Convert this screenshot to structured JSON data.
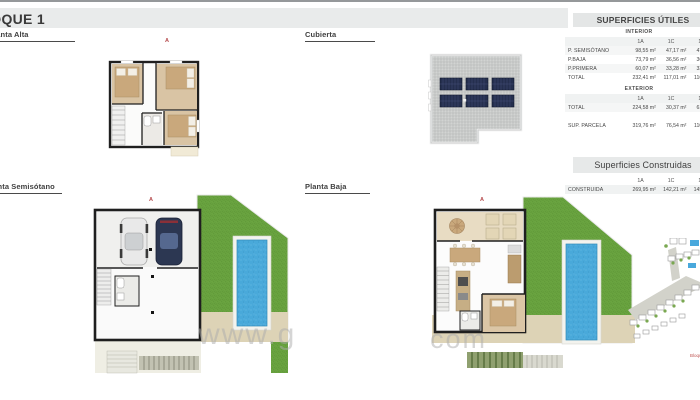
{
  "page": {
    "title": "BLOQUE 1"
  },
  "plans": {
    "planta_alta": {
      "label": "Planta Alta",
      "marker": "A"
    },
    "cubierta": {
      "label": "Cubierta"
    },
    "planta_semisotano": {
      "label": "Planta Semisótano",
      "marker": "A"
    },
    "planta_baja": {
      "label": "Planta Baja",
      "marker": "A"
    }
  },
  "tables": {
    "utiles": {
      "title": "SUPERFICIES ÚTILES",
      "interior": {
        "name": "INTERIOR",
        "columns": [
          "1A",
          "1C",
          "1D"
        ],
        "rows": [
          {
            "label": "P. SEMISÓTANO",
            "values": [
              "98,55 m²",
              "47,17 m²",
              "47,14 m²"
            ]
          },
          {
            "label": "P.BAJA",
            "values": [
              "73,79 m²",
              "36,56 m²",
              "36,46 m²"
            ]
          },
          {
            "label": "P.PRIMERA",
            "values": [
              "60,07 m²",
              "33,28 m²",
              "33,27 m²"
            ]
          },
          {
            "label": "TOTAL",
            "values": [
              "232,41 m²",
              "117,01 m²",
              "116,87 m²"
            ]
          }
        ]
      },
      "exterior": {
        "name": "EXTERIOR",
        "columns": [
          "1A",
          "1C",
          "1D"
        ],
        "rows": [
          {
            "label": "TOTAL",
            "values": [
              "224,58 m²",
              "30,37 m²",
              "61,15 m²"
            ]
          },
          {
            "label": "SUP. PARCELA",
            "values": [
              "319,76 m²",
              "76,54 m²",
              "110,65 m²"
            ]
          }
        ]
      }
    },
    "construidas": {
      "title": "Superficies Construidas",
      "columns": [
        "1A",
        "1C",
        "1D"
      ],
      "rows": [
        {
          "label": "CONSTRUIDA",
          "values": [
            "269,95 m²",
            "142,21 m²",
            "145,05 m²"
          ]
        }
      ]
    }
  },
  "watermark": {
    "part1": "www.g",
    "part2": "com"
  },
  "site_plan": {
    "caption": "Bloque"
  },
  "colors": {
    "accent_red": "#b5494b",
    "grass": "#68a23f",
    "pool_water": "#49a9da",
    "wall": "#1f1f1f",
    "solar_panel": "#252f4e",
    "sand_terrace": "#ddd3b6",
    "header_bar": "#e4e6e6",
    "title_bar": "#e9ebeb"
  }
}
